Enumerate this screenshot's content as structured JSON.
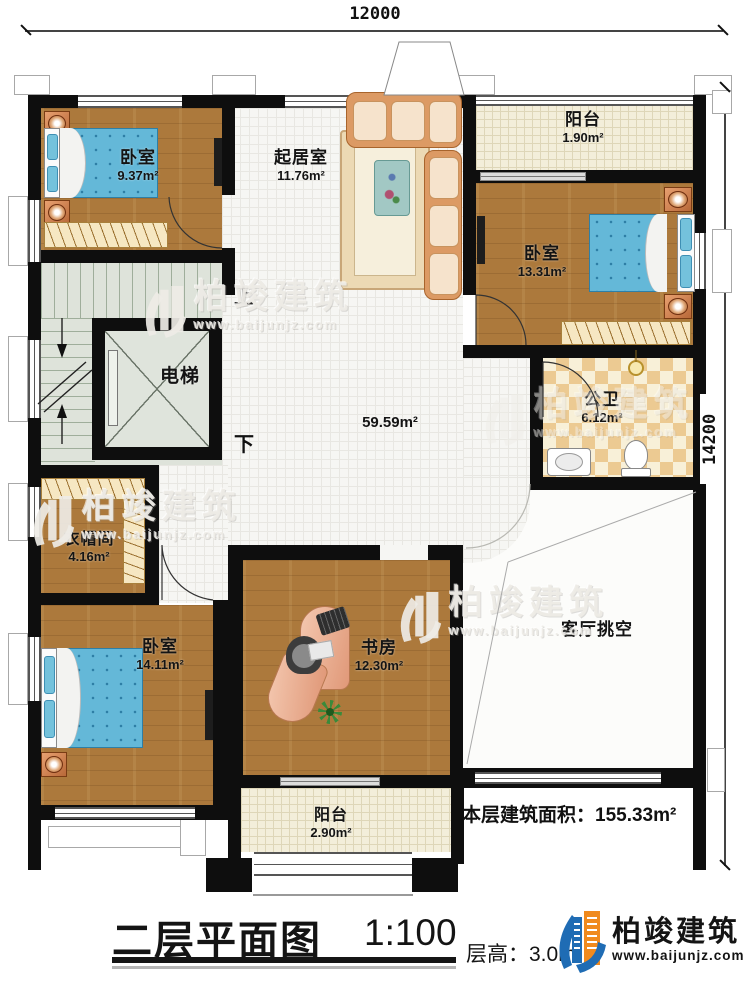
{
  "dimensions": {
    "top": "12000",
    "right": "14200"
  },
  "rooms": {
    "bedroom_top_left": {
      "name": "卧室",
      "area": "9.37m²"
    },
    "living_room": {
      "name": "起居室",
      "area": "11.76m²"
    },
    "balcony_top": {
      "name": "阳台",
      "area": "1.90m²"
    },
    "bedroom_right": {
      "name": "卧室",
      "area": "13.31m²"
    },
    "elevator": {
      "name": "电梯"
    },
    "hall": {
      "area": "59.59m²"
    },
    "bathroom": {
      "name": "公卫",
      "area": "6.12m²"
    },
    "cloakroom": {
      "name": "衣帽间",
      "area": "4.16m²"
    },
    "bedroom_bottom_left": {
      "name": "卧室",
      "area": "14.11m²"
    },
    "study": {
      "name": "书房",
      "area": "12.30m²"
    },
    "living_void": {
      "name": "客厅挑空"
    },
    "balcony_bottom": {
      "name": "阳台",
      "area": "2.90m²"
    }
  },
  "stairs": {
    "up": "上",
    "down": "下"
  },
  "floor_area": {
    "label": "本层建筑面积：",
    "value": "155.33m²"
  },
  "title_block": {
    "title": "二层平面图",
    "scale": "1:100",
    "floor_height_label": "层高：",
    "floor_height_value": "3.0m"
  },
  "brand": {
    "name": "柏竣建筑",
    "website": "www.baijunjz.com"
  },
  "watermark": {
    "name": "柏竣建筑",
    "website": "www.baijunjz.com"
  },
  "colors": {
    "wall": "#0e0e0e",
    "wood": "#ac793c",
    "tile": "#f6f6f3",
    "balcony_tile": "#f3eeda",
    "bath_tile": "#ecca92",
    "stairs": "#dee3da",
    "bed_blue": "#64b8d8",
    "brand_blue": "#1f6cb4",
    "brand_orange": "#f08a1e"
  }
}
